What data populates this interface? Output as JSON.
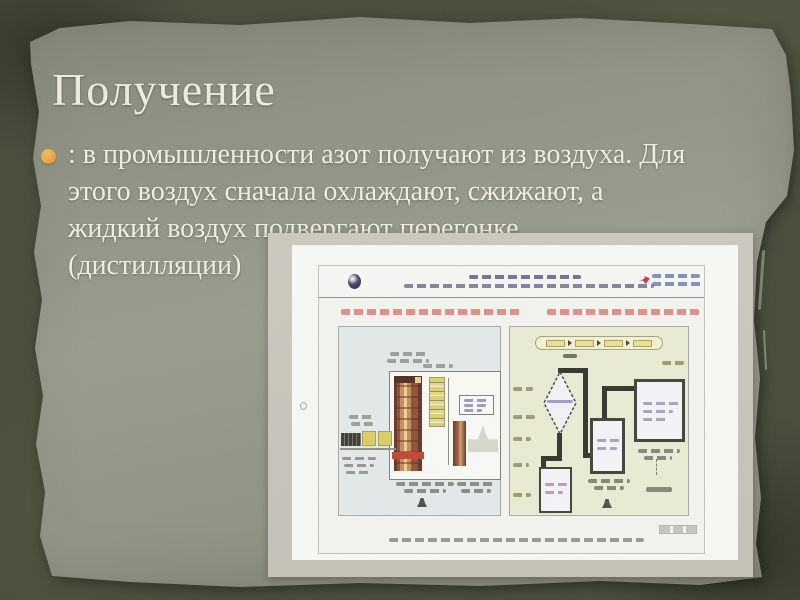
{
  "slide": {
    "title": "Получение",
    "bullet_lines": [
      ": в промышленности азот получают из воздуха. Для",
      "этого воздух сначала охлаждают, сжижают, а",
      "жидкий воздух подвергают перегонке",
      "(дистилляции)"
    ]
  },
  "embedded_figure": {
    "kind": "photo-of-slide",
    "text_legible": false,
    "regions": [
      "university-header-with-logos",
      "left-panel-rectification-column-diagram",
      "right-panel-process-flow-diagram",
      "caption-line"
    ]
  },
  "colors": {
    "background_dark_olive": "#3e4431",
    "paper_panel": "#8e9181",
    "title_text": "#f2f0e6",
    "body_text": "#f5f3ea",
    "bullet_marker_orange": "#f2a33c",
    "photo_frame_gray": "#c9c6bc",
    "figure_left_panel_bg": "#e7edee",
    "figure_right_panel_bg": "#edefd6",
    "figure_heading_pink": "#e07a76",
    "figure_column_brown": "#8a4a33",
    "figure_equipment_yellow": "#ddd05e",
    "figure_pipe_dark": "#2c2c26"
  }
}
